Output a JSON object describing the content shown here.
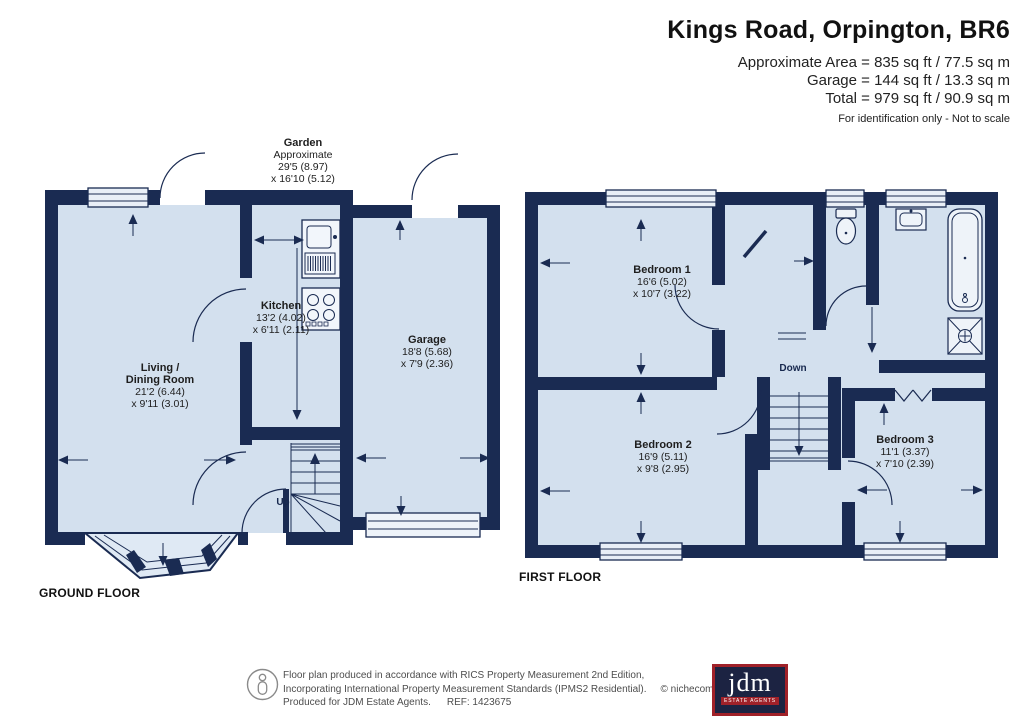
{
  "header": {
    "title": "Kings Road, Orpington, BR6",
    "area_lines": [
      "Approximate Area = 835 sq ft / 77.5 sq m",
      "Garage = 144 sq ft / 13.3 sq m",
      "Total = 979 sq ft / 90.9 sq m"
    ],
    "disclaimer": "For identification only - Not to scale"
  },
  "garden_label": {
    "name": "Garden",
    "note": "Approximate",
    "dim1": "29'5 (8.97)",
    "dim2": "x 16'10 (5.12)"
  },
  "ground_floor": {
    "label": "GROUND FLOOR",
    "stairs_label": "Up",
    "rooms": {
      "living": {
        "name1": "Living /",
        "name2": "Dining Room",
        "dim1": "21'2 (6.44)",
        "dim2": "x 9'11 (3.01)"
      },
      "kitchen": {
        "name": "Kitchen",
        "dim1": "13'2 (4.02)",
        "dim2": "x 6'11 (2.11)"
      },
      "garage": {
        "name": "Garage",
        "dim1": "18'8 (5.68)",
        "dim2": "x 7'9 (2.36)"
      }
    }
  },
  "first_floor": {
    "label": "FIRST FLOOR",
    "stairs_label": "Down",
    "rooms": {
      "bedroom1": {
        "name": "Bedroom 1",
        "dim1": "16'6 (5.02)",
        "dim2": "x 10'7 (3.22)"
      },
      "bedroom2": {
        "name": "Bedroom 2",
        "dim1": "16'9 (5.11)",
        "dim2": "x 9'8 (2.95)"
      },
      "bedroom3": {
        "name": "Bedroom 3",
        "dim1": "11'1 (3.37)",
        "dim2": "x 7'10 (2.39)"
      }
    }
  },
  "footer": {
    "line1": "Floor plan produced in accordance with RICS Property Measurement 2nd Edition,",
    "line2": "Incorporating International Property Measurement Standards (IPMS2 Residential).",
    "copyright": "© nichecom 2026.",
    "line3": "Produced for JDM Estate Agents.",
    "ref": "REF: 1423675",
    "logo": {
      "text": "jdm",
      "subtext": "ESTATE AGENTS"
    }
  },
  "colors": {
    "wall": "#1a2b52",
    "room_fill": "#d3e0ee",
    "window_fill": "#e9eff7",
    "logo_navy": "#1c2342",
    "logo_red": "#a02129"
  }
}
